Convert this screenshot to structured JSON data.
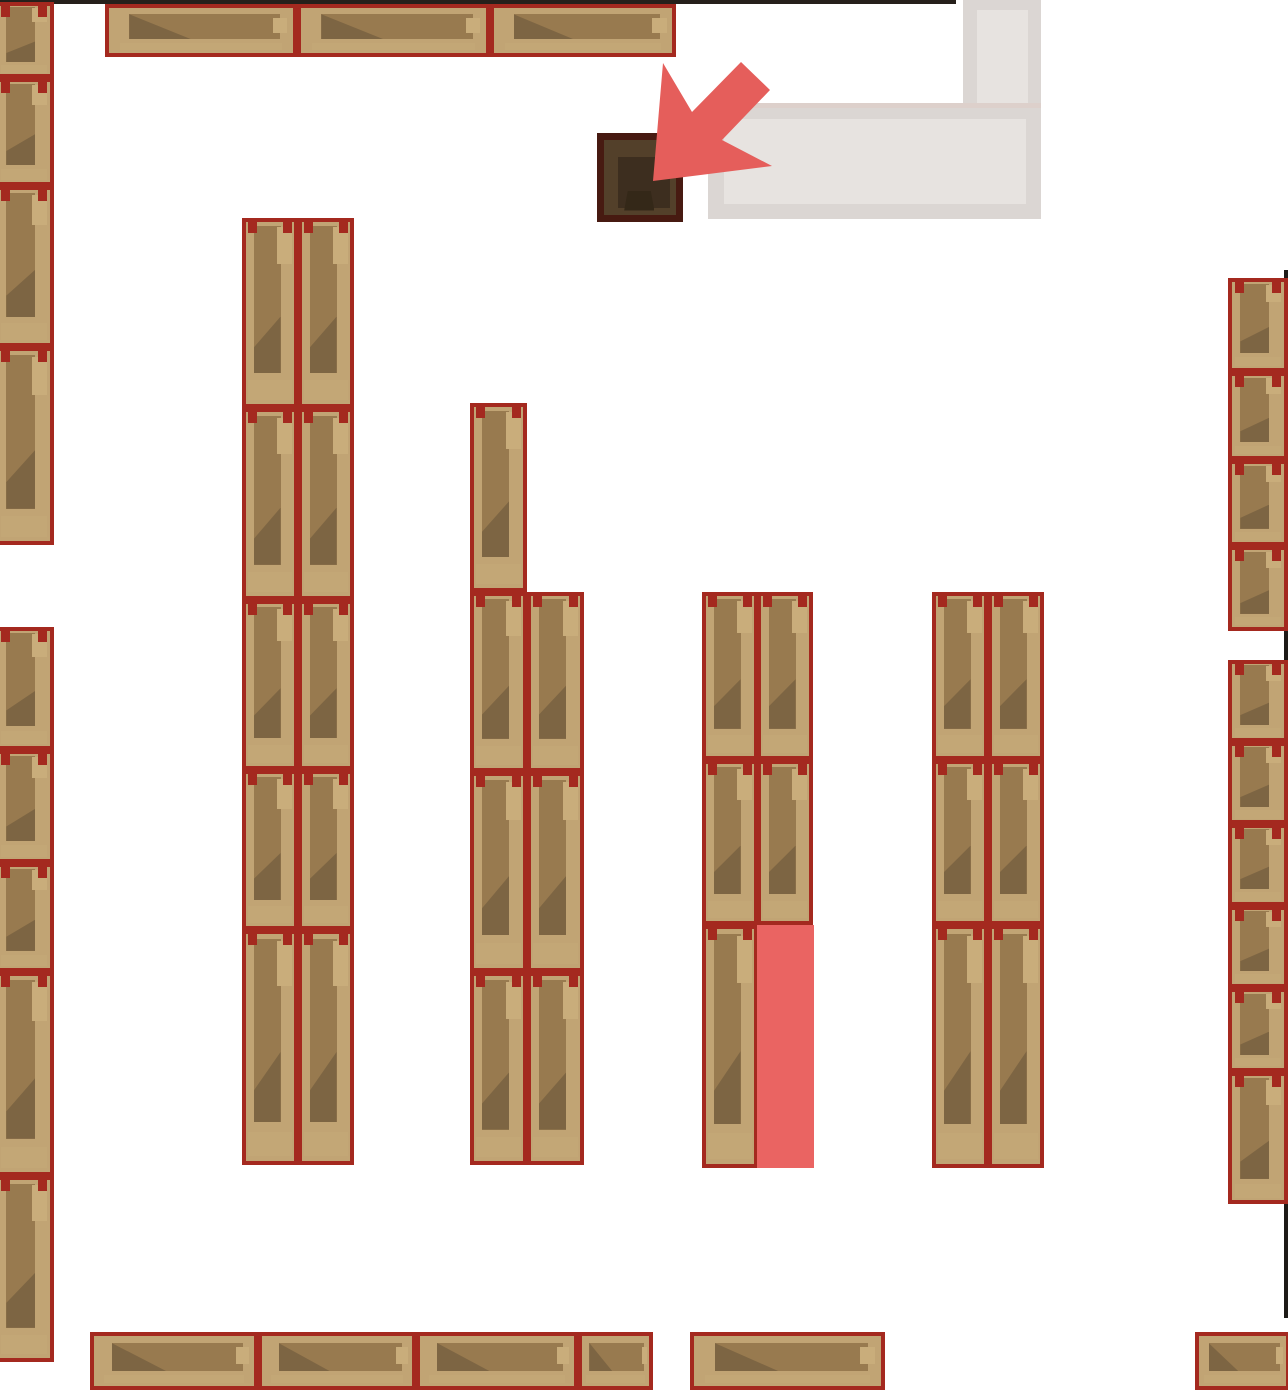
{
  "scene": {
    "width": 1288,
    "height": 1392,
    "background": "#ffffff"
  },
  "colors": {
    "shelf_border": "#a4291f",
    "shelf_wood_base": "#c1a474",
    "shelf_wood_band": "#987a4f",
    "shelf_wood_shadow": "#7d6543",
    "shelf_wood_light": "#c9ad7b",
    "counter_gray": "#dbd6d3",
    "counter_gray_light": "#e7e3e0",
    "desk_border": "#471a11",
    "desk_fill": "#53402a",
    "arrow_red": "#e55e5b",
    "highlight_red": "#ea6462",
    "wall_dark": "#26201b"
  },
  "walls": {
    "top_strip": {
      "x": 0,
      "y": 0,
      "w": 956,
      "h": 4,
      "color": "#26201b"
    },
    "right_strip": {
      "x": 1284,
      "y": 270,
      "w": 4,
      "h": 1048,
      "color": "#1e1a17"
    }
  },
  "counter": {
    "vertical": {
      "x": 963,
      "y": 0,
      "w": 78,
      "h": 219,
      "color": "#dbd6d3"
    },
    "vertical_inner": {
      "x": 977,
      "y": 10,
      "w": 51,
      "h": 196,
      "color": "#e7e3e0"
    },
    "horizontal": {
      "x": 708,
      "y": 103,
      "w": 333,
      "h": 116,
      "color": "#dbd6d3"
    },
    "horizontal_inner": {
      "x": 724,
      "y": 119,
      "w": 302,
      "h": 85,
      "color": "#e7e3e0"
    }
  },
  "desk": {
    "rect": {
      "x": 597,
      "y": 133,
      "w": 86,
      "h": 89
    }
  },
  "highlight_cell": {
    "rect": {
      "x": 757,
      "y": 925,
      "w": 57,
      "h": 243,
      "color": "#ea6462"
    }
  },
  "arrow": {
    "color": "#e55e5b",
    "points": "653,181 663,63 692,112 741,62 770,90 722,140 772,166"
  },
  "shelves": [
    {
      "x": -6,
      "y": 2,
      "w": 60,
      "h": 76,
      "o": "v"
    },
    {
      "x": -6,
      "y": 78,
      "w": 60,
      "h": 108,
      "o": "v"
    },
    {
      "x": -6,
      "y": 186,
      "w": 60,
      "h": 161,
      "o": "v"
    },
    {
      "x": -6,
      "y": 347,
      "w": 60,
      "h": 198,
      "o": "v"
    },
    {
      "x": -6,
      "y": 627,
      "w": 60,
      "h": 123,
      "o": "v"
    },
    {
      "x": -6,
      "y": 750,
      "w": 60,
      "h": 113,
      "o": "v"
    },
    {
      "x": -6,
      "y": 863,
      "w": 60,
      "h": 109,
      "o": "v"
    },
    {
      "x": -6,
      "y": 972,
      "w": 60,
      "h": 204,
      "o": "v"
    },
    {
      "x": -6,
      "y": 1176,
      "w": 60,
      "h": 186,
      "o": "v"
    },
    {
      "x": 105,
      "y": 4,
      "w": 192,
      "h": 53,
      "o": "h"
    },
    {
      "x": 297,
      "y": 4,
      "w": 193,
      "h": 53,
      "o": "h"
    },
    {
      "x": 490,
      "y": 4,
      "w": 186,
      "h": 53,
      "o": "h"
    },
    {
      "x": 242,
      "y": 218,
      "w": 56,
      "h": 190,
      "o": "v"
    },
    {
      "x": 298,
      "y": 218,
      "w": 56,
      "h": 190,
      "o": "v"
    },
    {
      "x": 242,
      "y": 408,
      "w": 56,
      "h": 192,
      "o": "v"
    },
    {
      "x": 298,
      "y": 408,
      "w": 56,
      "h": 192,
      "o": "v"
    },
    {
      "x": 242,
      "y": 600,
      "w": 56,
      "h": 170,
      "o": "v"
    },
    {
      "x": 298,
      "y": 600,
      "w": 56,
      "h": 170,
      "o": "v"
    },
    {
      "x": 242,
      "y": 770,
      "w": 56,
      "h": 160,
      "o": "v"
    },
    {
      "x": 298,
      "y": 770,
      "w": 56,
      "h": 160,
      "o": "v"
    },
    {
      "x": 242,
      "y": 930,
      "w": 56,
      "h": 235,
      "o": "v"
    },
    {
      "x": 298,
      "y": 930,
      "w": 56,
      "h": 235,
      "o": "v"
    },
    {
      "x": 470,
      "y": 403,
      "w": 57,
      "h": 189,
      "o": "v"
    },
    {
      "x": 470,
      "y": 592,
      "w": 57,
      "h": 180,
      "o": "v"
    },
    {
      "x": 527,
      "y": 592,
      "w": 57,
      "h": 180,
      "o": "v"
    },
    {
      "x": 470,
      "y": 772,
      "w": 57,
      "h": 200,
      "o": "v"
    },
    {
      "x": 527,
      "y": 772,
      "w": 57,
      "h": 200,
      "o": "v"
    },
    {
      "x": 470,
      "y": 972,
      "w": 57,
      "h": 193,
      "o": "v"
    },
    {
      "x": 527,
      "y": 972,
      "w": 57,
      "h": 193,
      "o": "v"
    },
    {
      "x": 702,
      "y": 592,
      "w": 56,
      "h": 168,
      "o": "v"
    },
    {
      "x": 757,
      "y": 592,
      "w": 56,
      "h": 168,
      "o": "v"
    },
    {
      "x": 702,
      "y": 760,
      "w": 56,
      "h": 165,
      "o": "v"
    },
    {
      "x": 757,
      "y": 760,
      "w": 56,
      "h": 165,
      "o": "v"
    },
    {
      "x": 702,
      "y": 925,
      "w": 56,
      "h": 243,
      "o": "v"
    },
    {
      "x": 932,
      "y": 592,
      "w": 56,
      "h": 168,
      "o": "v"
    },
    {
      "x": 988,
      "y": 592,
      "w": 56,
      "h": 168,
      "o": "v"
    },
    {
      "x": 932,
      "y": 760,
      "w": 56,
      "h": 165,
      "o": "v"
    },
    {
      "x": 988,
      "y": 760,
      "w": 56,
      "h": 165,
      "o": "v"
    },
    {
      "x": 932,
      "y": 925,
      "w": 56,
      "h": 243,
      "o": "v"
    },
    {
      "x": 988,
      "y": 925,
      "w": 56,
      "h": 243,
      "o": "v"
    },
    {
      "x": 1228,
      "y": 278,
      "w": 60,
      "h": 94,
      "o": "v"
    },
    {
      "x": 1228,
      "y": 372,
      "w": 60,
      "h": 88,
      "o": "v"
    },
    {
      "x": 1228,
      "y": 460,
      "w": 60,
      "h": 86,
      "o": "v"
    },
    {
      "x": 1228,
      "y": 546,
      "w": 60,
      "h": 85,
      "o": "v"
    },
    {
      "x": 1228,
      "y": 660,
      "w": 60,
      "h": 82,
      "o": "v"
    },
    {
      "x": 1228,
      "y": 742,
      "w": 60,
      "h": 82,
      "o": "v"
    },
    {
      "x": 1228,
      "y": 824,
      "w": 60,
      "h": 82,
      "o": "v"
    },
    {
      "x": 1228,
      "y": 906,
      "w": 60,
      "h": 82,
      "o": "v"
    },
    {
      "x": 1228,
      "y": 988,
      "w": 60,
      "h": 84,
      "o": "v"
    },
    {
      "x": 1228,
      "y": 1072,
      "w": 60,
      "h": 132,
      "o": "v"
    },
    {
      "x": 90,
      "y": 1332,
      "w": 168,
      "h": 58,
      "o": "h"
    },
    {
      "x": 258,
      "y": 1332,
      "w": 158,
      "h": 58,
      "o": "h"
    },
    {
      "x": 416,
      "y": 1332,
      "w": 162,
      "h": 58,
      "o": "h"
    },
    {
      "x": 578,
      "y": 1332,
      "w": 75,
      "h": 58,
      "o": "h"
    },
    {
      "x": 690,
      "y": 1332,
      "w": 195,
      "h": 58,
      "o": "h"
    },
    {
      "x": 1195,
      "y": 1332,
      "w": 95,
      "h": 58,
      "o": "h"
    }
  ]
}
